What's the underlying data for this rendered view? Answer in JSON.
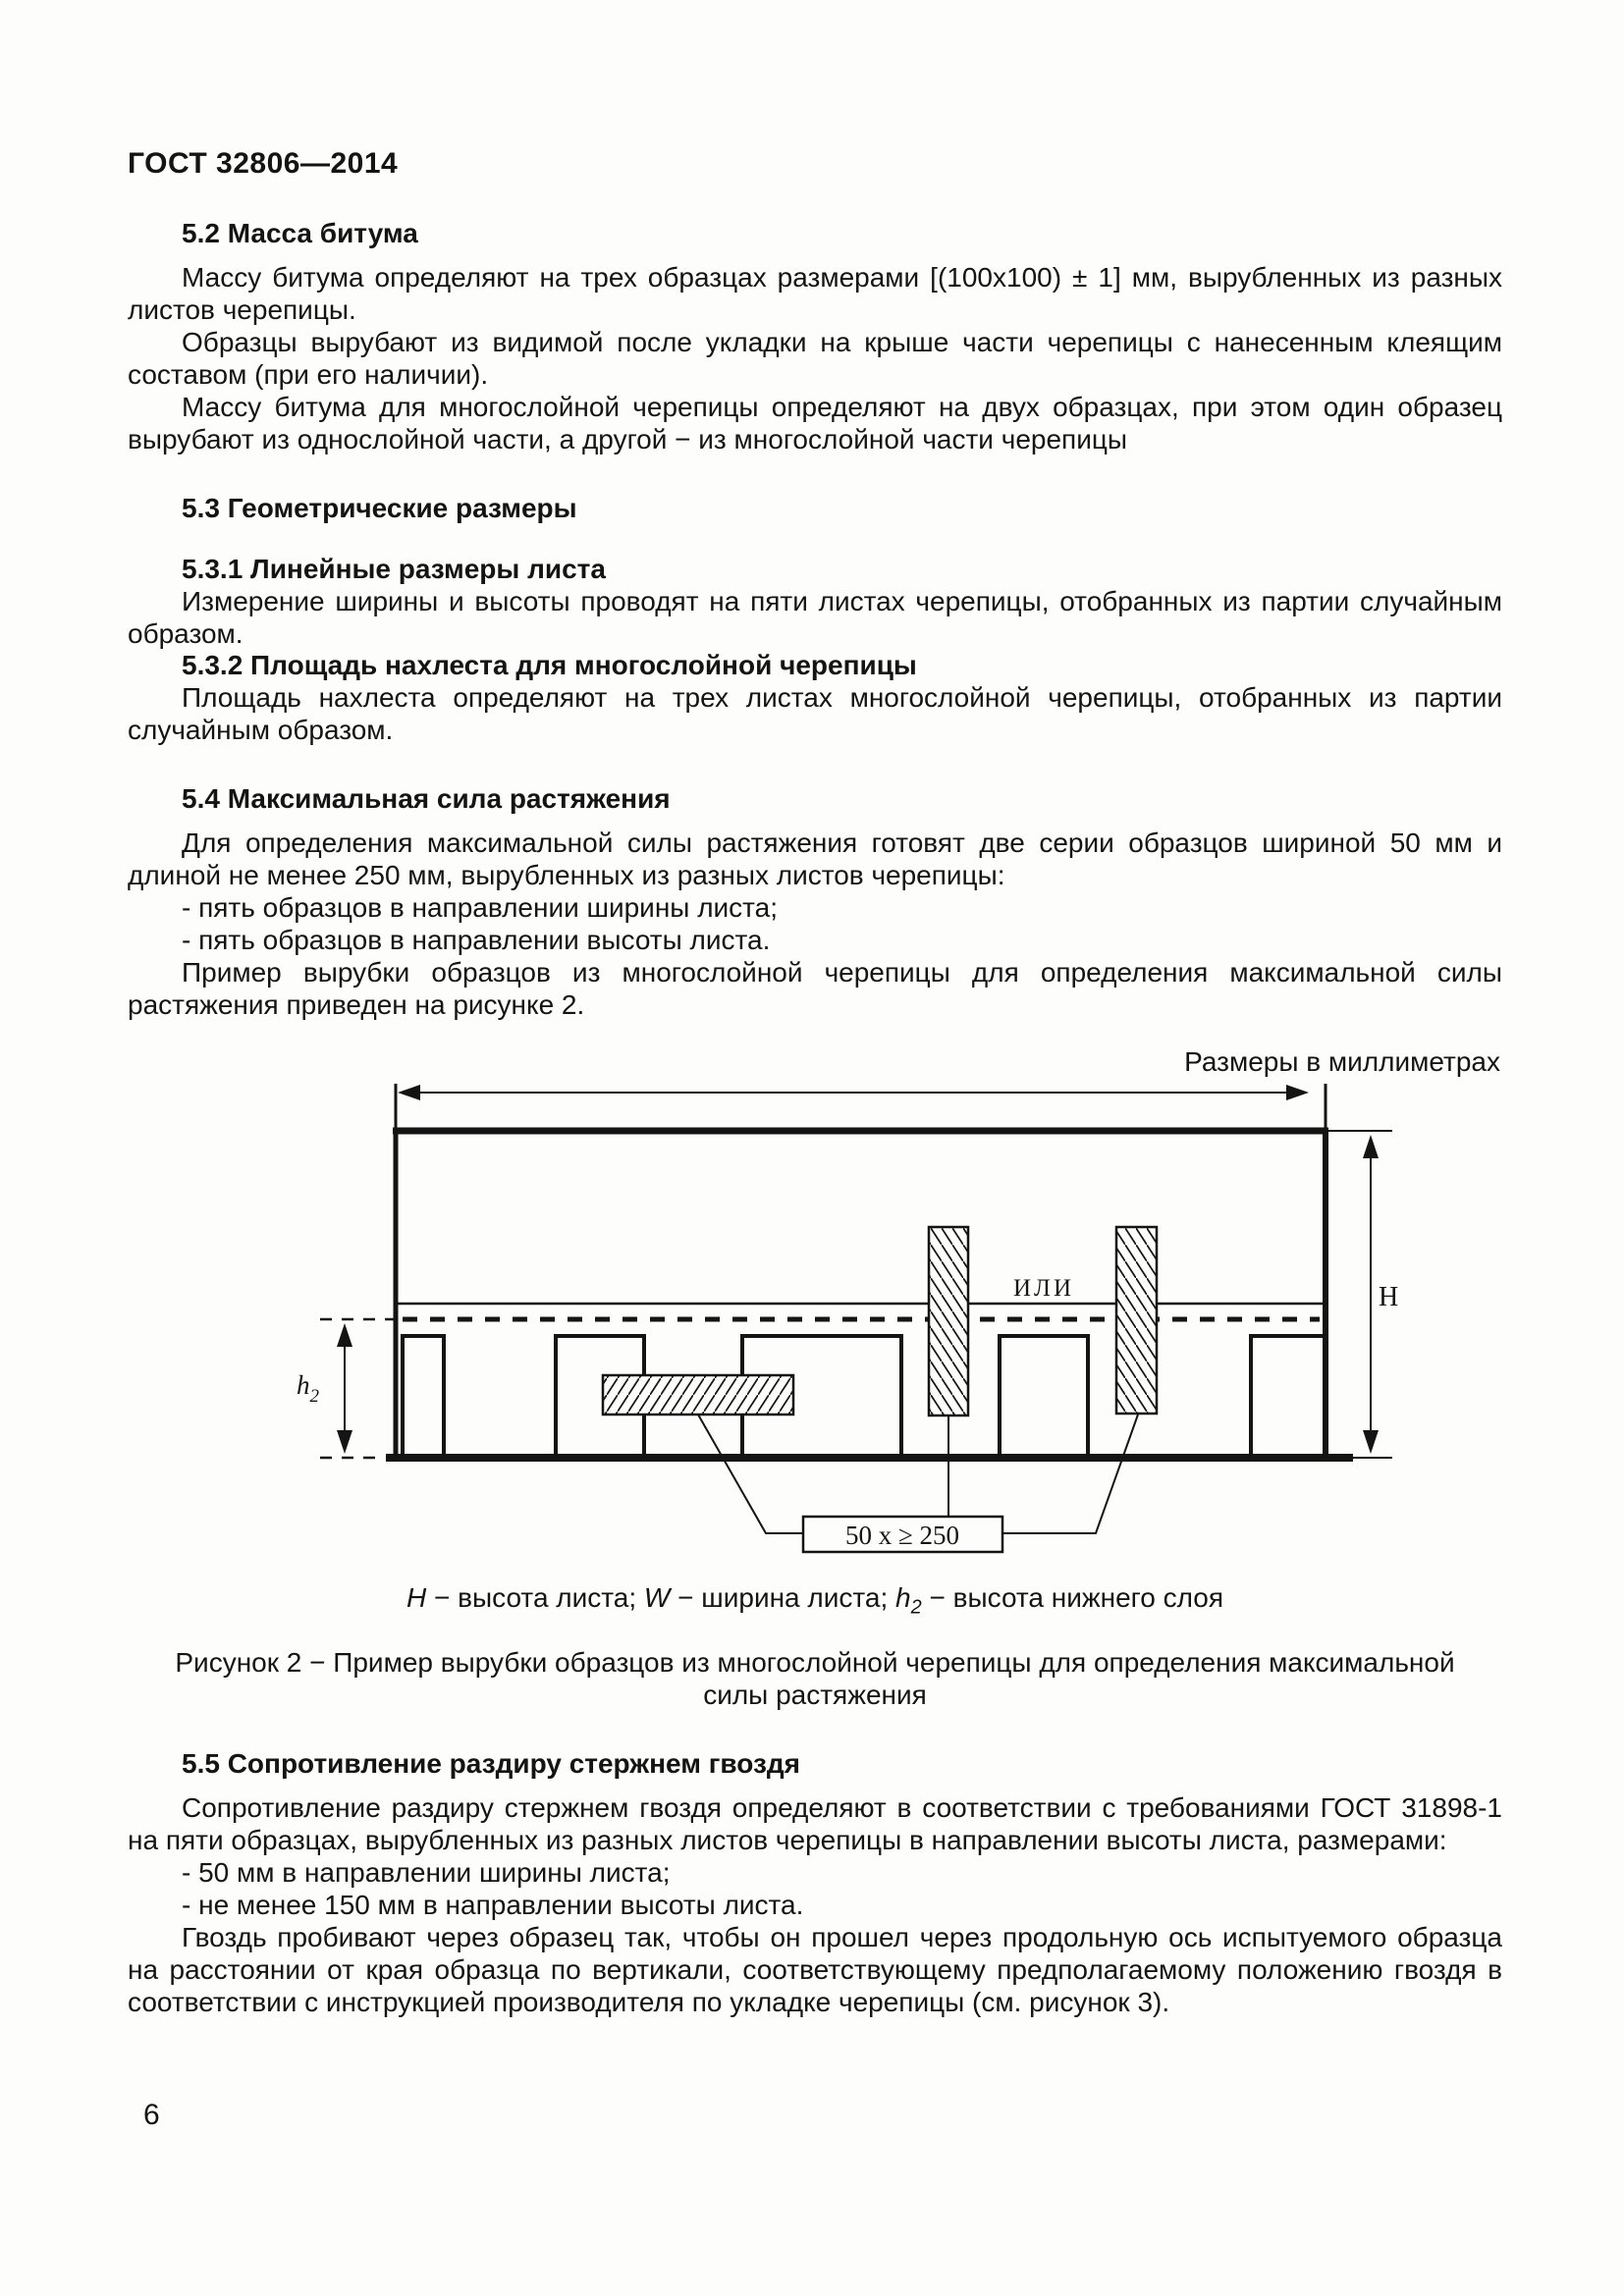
{
  "header": {
    "doc_code": "ГОСТ 32806—2014"
  },
  "sections": {
    "s52": {
      "title": "5.2 Масса битума",
      "p1": "Массу битума определяют на трех образцах размерами [(100х100) ± 1] мм, вырубленных из разных листов черепицы.",
      "p2": "Образцы вырубают из видимой после укладки на крыше части черепицы с нанесенным клеящим составом (при его наличии).",
      "p3": "Массу битума для многослойной черепицы определяют на двух образцах, при этом один образец вырубают из однослойной части, а другой − из многослойной части черепицы"
    },
    "s53": {
      "title": "5.3 Геометрические размеры",
      "s531": {
        "title": "5.3.1 Линейные размеры листа",
        "p1": "Измерение ширины и высоты проводят на пяти листах черепицы, отобранных из партии случайным образом."
      },
      "s532": {
        "title": "5.3.2 Площадь нахлеста для многослойной черепицы",
        "p1": "Площадь нахлеста определяют на трех листах многослойной черепицы, отобранных из партии случайным образом."
      }
    },
    "s54": {
      "title": "5.4 Максимальная сила растяжения",
      "p1": "Для определения максимальной силы растяжения готовят две серии образцов шириной 50 мм и длиной не менее 250 мм, вырубленных из разных листов черепицы:",
      "items": [
        "- пять образцов в направлении ширины листа;",
        "- пять образцов в направлении высоты листа."
      ],
      "p2": "Пример вырубки образцов из многослойной черепицы для определения максимальной силы растяжения приведен на рисунке 2."
    },
    "s55": {
      "title": "5.5 Сопротивление раздиру стержнем гвоздя",
      "p1": "Сопротивление раздиру стержнем гвоздя определяют в соответствии с требованиями ГОСТ 31898-1 на пяти образцах, вырубленных из разных листов черепицы в направлении высоты листа, размерами:",
      "items": [
        "- 50 мм в направлении ширины листа;",
        "- не менее 150 мм в направлении высоты листа."
      ],
      "p2": "Гвоздь пробивают через образец так, чтобы он прошел через продольную ось испытуемого образца на расстоянии от края образца по вертикали, соответствующему предполагаемому положению гвоздя в соответствии с инструкцией производителя по укладке черепицы (см. рисунок 3)."
    }
  },
  "figure": {
    "units_note": "Размеры в миллиметрах",
    "or_label": "ИЛИ",
    "sample_size_label": "50 x ≥ 250",
    "dim_H": "H",
    "dim_h": "h",
    "dim_h_sub": "2",
    "legend": {
      "v1": "H",
      "s1": " − высота листа; ",
      "v2": "W",
      "s2": " − ширина листа; ",
      "v3": "h",
      "v3sub": "2",
      "s3": " − высота нижнего слоя"
    },
    "caption_line1": "Рисунок 2 − Пример вырубки образцов из многослойной черепицы для определения максимальной",
    "caption_line2": "силы растяжения"
  },
  "footer": {
    "page_number": "6"
  }
}
